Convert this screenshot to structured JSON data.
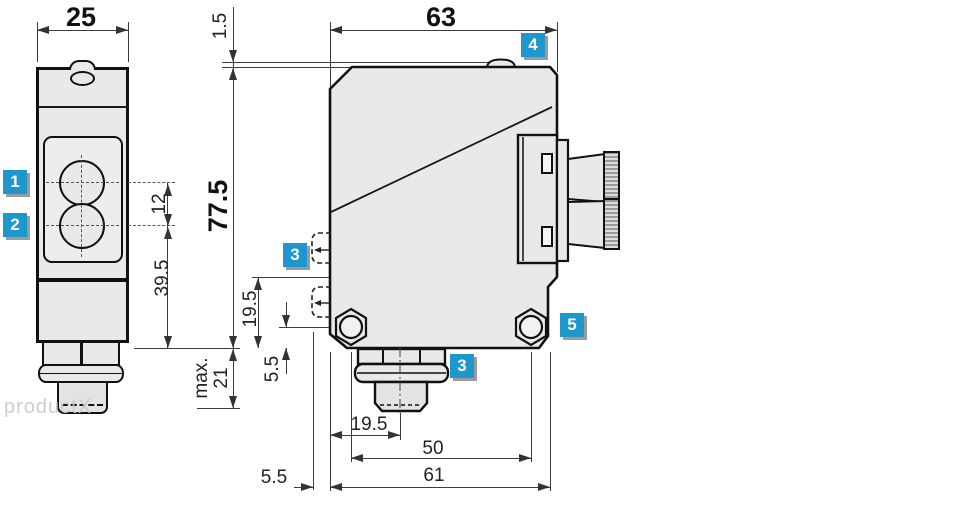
{
  "drawing_title": "sensor-dimensional-drawing",
  "watermark": "productX",
  "colors": {
    "accent_blue": "#1d97cc",
    "body_fill": "#e9e9e9",
    "outline": "#111111",
    "dimension_line": "#3c3c3c"
  },
  "front_view": {
    "width": "25",
    "lens_spacing": "12",
    "lens_to_bottom": "39.5"
  },
  "side_view": {
    "width": "63",
    "top_offset": "1.5",
    "height": "77.5",
    "max_label": "max.",
    "max_value": "21",
    "mount_to_bottom": "19.5",
    "hex_to_bottom": "5.5",
    "face_offset": "5.5",
    "edge_to_plug": "19.5",
    "hole_spacing": "50",
    "base_width": "61"
  },
  "callouts": {
    "c1": "1",
    "c2": "2",
    "c3_left": "3",
    "c3_bottom": "3",
    "c4": "4",
    "c5": "5"
  }
}
